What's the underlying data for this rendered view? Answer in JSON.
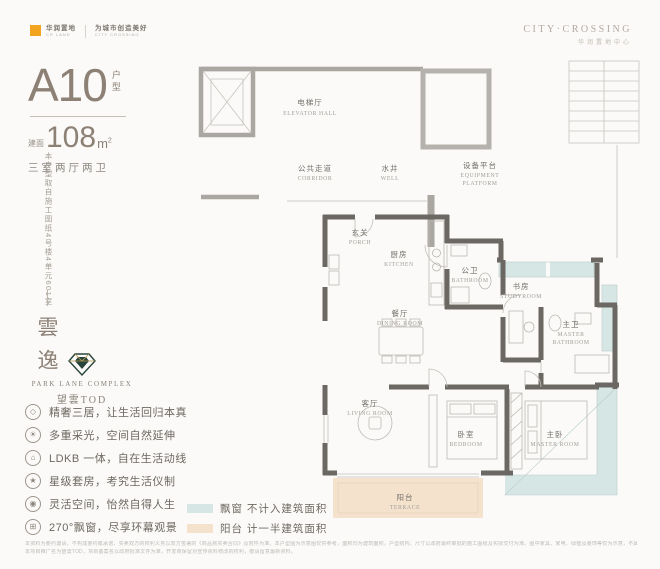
{
  "brand_left": {
    "name": "华润置地",
    "name_sub": "CR LAND",
    "partner": "为城市创造美好",
    "partner_sub": "CITY CROSSING"
  },
  "brand_right": {
    "line1": "CITY·CROSSING",
    "line2": "华润置地中心"
  },
  "unit": {
    "code": "A10",
    "code_suffix": "户型",
    "area_prefix": "建面",
    "area_value": "108",
    "area_unit": "m",
    "area_sup": "2",
    "layout": "三室两厅两卫"
  },
  "side": {
    "note_vertical": "本户型取自施工图纸4号楼4单元601室",
    "name_vertical": "雲逸"
  },
  "park_lane": {
    "en": "PARK LANE COMPLEX",
    "cn": "望雲TOD"
  },
  "features": [
    {
      "glyph": "◇",
      "text": "精奢三居，让生活回归本真"
    },
    {
      "glyph": "☀",
      "text": "多重采光，空间自然延伸"
    },
    {
      "glyph": "⌂",
      "text": "LDKB 一体，自在生活动线"
    },
    {
      "glyph": "★",
      "text": "星级套房，考究生活仪制"
    },
    {
      "glyph": "◉",
      "text": "灵活空间，怡然自得人生"
    },
    {
      "glyph": "⊞",
      "text": "270°飘窗，尽享环幕观景"
    }
  ],
  "plan": {
    "rooms": {
      "elevator_hall": {
        "cn": "电梯厅",
        "en": "ELEVATOR HALL"
      },
      "corridor": {
        "cn": "公共走道",
        "en": "CORRIDOR"
      },
      "well": {
        "cn": "水井",
        "en": "WELL"
      },
      "equipment_platform": {
        "cn": "设备平台",
        "en1": "EQUIPMENT",
        "en2": "PLATFORM"
      },
      "porch": {
        "cn": "玄关",
        "en": "PORCH"
      },
      "kitchen": {
        "cn": "厨房",
        "en": "KITCHEN"
      },
      "bathroom": {
        "cn": "公卫",
        "en": "BATHROOM"
      },
      "studyroom": {
        "cn": "书房",
        "en": "STUDYROOM"
      },
      "dining": {
        "cn": "餐厅",
        "en": "DINING ROOM"
      },
      "master_bathroom": {
        "cn": "主卫",
        "en1": "MASTER",
        "en2": "BATHROOM"
      },
      "living": {
        "cn": "客厅",
        "en": "LIVING ROOM"
      },
      "bedroom": {
        "cn": "卧室",
        "en": "BEDROOM"
      },
      "master_room": {
        "cn": "主卧",
        "en": "MASTER ROOM"
      },
      "terrace": {
        "cn": "阳台",
        "en": "TERRACE"
      }
    }
  },
  "legend": {
    "items": [
      {
        "color": "#d6e6e4",
        "label": "飘窗 不计入建筑面积"
      },
      {
        "color": "#f4e2cd",
        "label": "阳台 计一半建筑面积"
      }
    ]
  },
  "disclaimer": {
    "line1": "本资料为要约邀请，不构成要约或承诺，买卖双方的权利义务以双方签署的《商品房买卖合同》及附件为准。本户型图为示意图仅供参考，面积均为建筑面积，户型结构、尺寸以政府最终审批的施工图纸及实际交付为准。图中家具、家电、绿植及装饰等仅为示意，不属于交付标准。",
    "line2": "本项目推广名为望雲TOD，项目备案名以政府批准文件为准，开发商保留对宣传资料修改的权利，敬请留意最新资料。"
  },
  "colors": {
    "accent_orange": "#f2a41f",
    "taupe_text": "#8d8176",
    "bay_window": "#d6e6e4",
    "terrace": "#f4e2cd",
    "wall_dark": "#6b6763",
    "wall_light": "#aaa6a1"
  }
}
